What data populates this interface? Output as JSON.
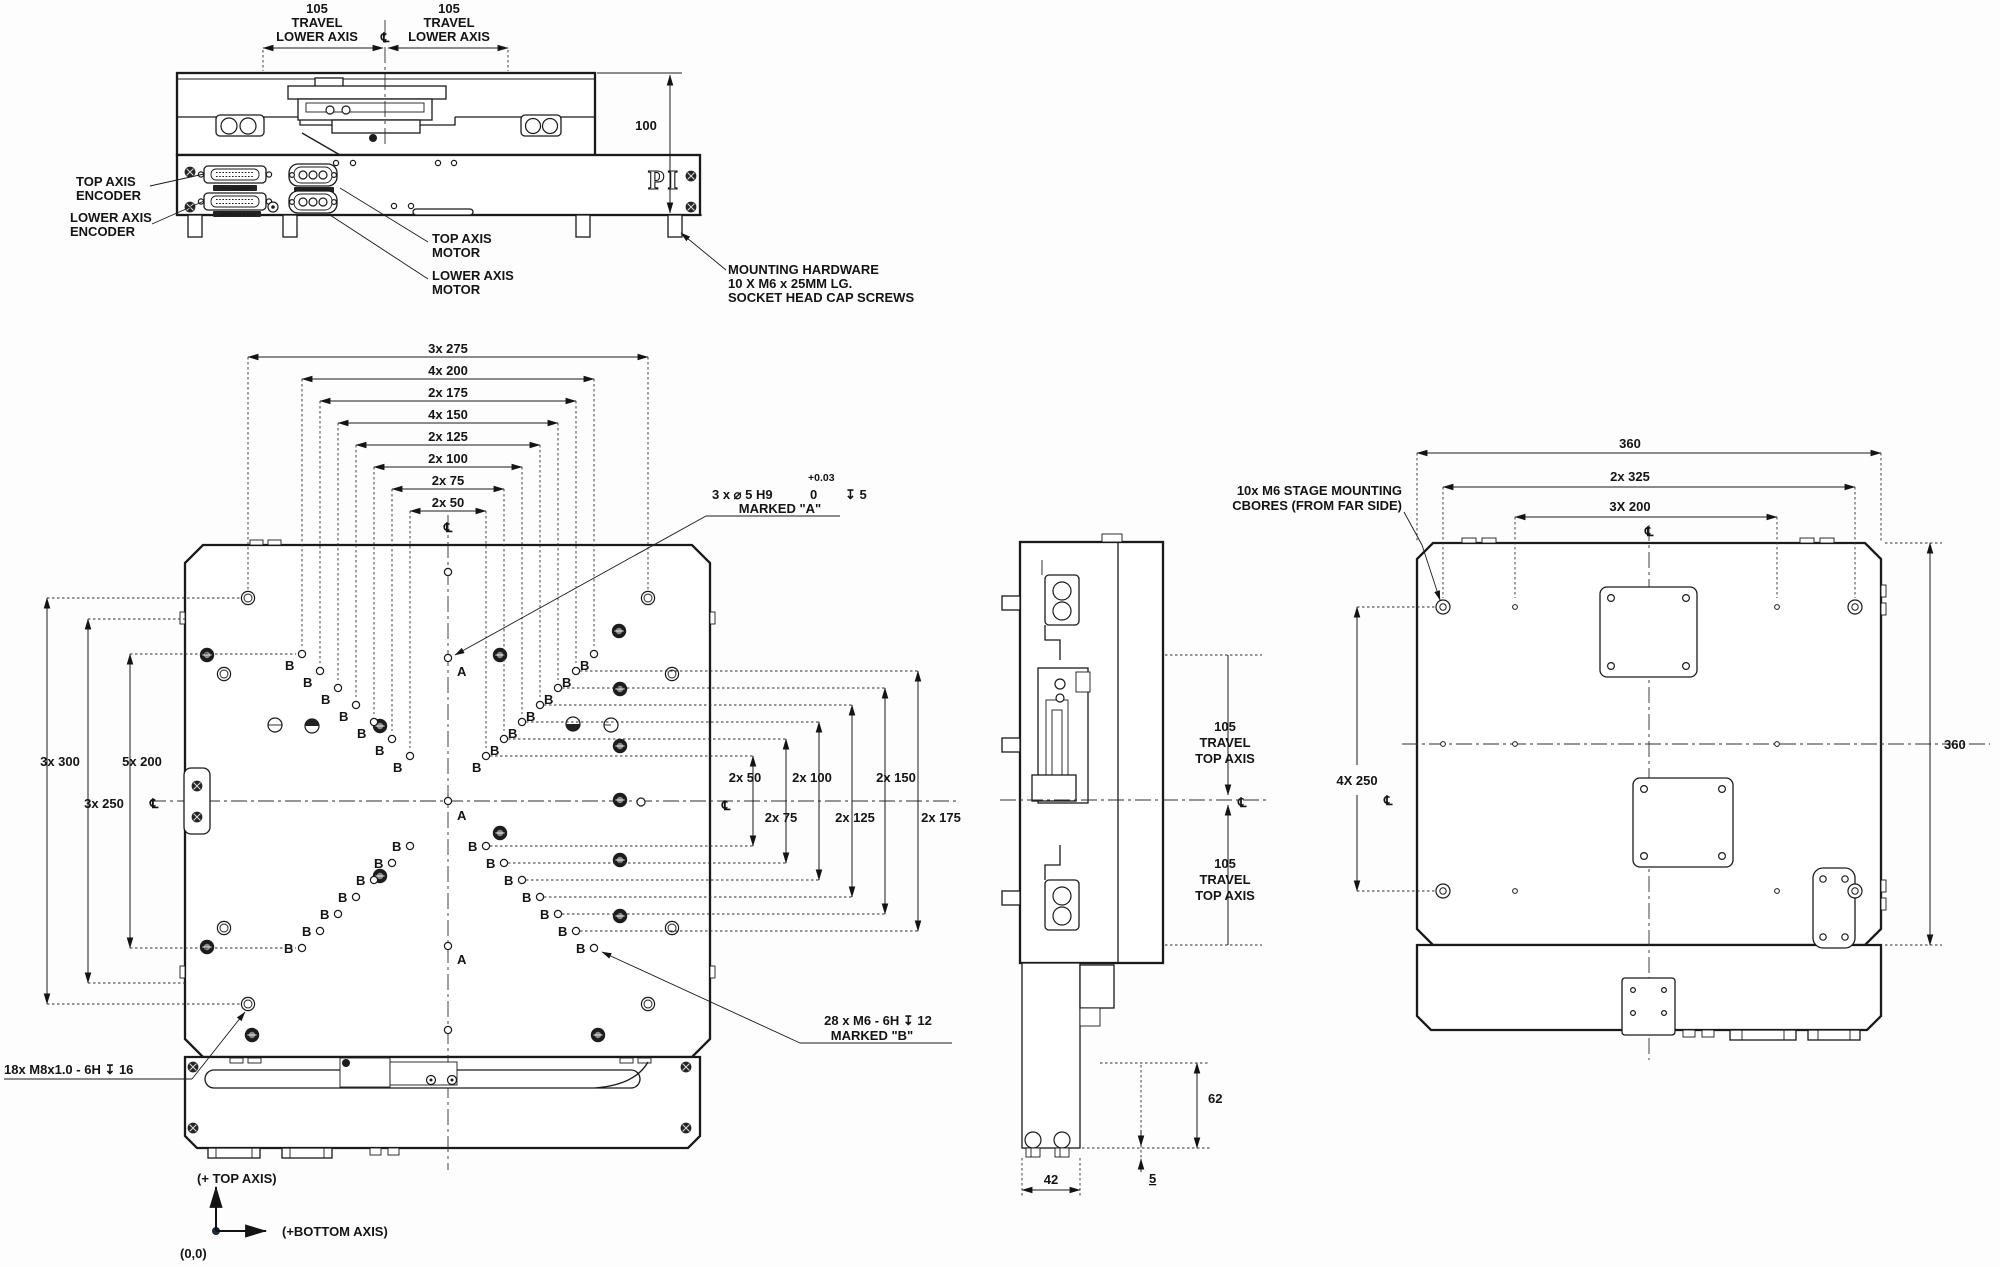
{
  "brand": "PI",
  "symbols": {
    "centerline": "℄",
    "marker_a": "A",
    "marker_b": "B"
  },
  "front": {
    "travel_left": [
      "105",
      "TRAVEL",
      "LOWER AXIS"
    ],
    "travel_right": [
      "105",
      "TRAVEL",
      "LOWER AXIS"
    ],
    "dim_height": "100",
    "encoder_top": [
      "TOP AXIS",
      "ENCODER"
    ],
    "encoder_lower": [
      "LOWER AXIS",
      "ENCODER"
    ],
    "motor_top": [
      "TOP AXIS",
      "MOTOR"
    ],
    "motor_lower": [
      "LOWER AXIS",
      "MOTOR"
    ],
    "mounting": [
      "MOUNTING HARDWARE",
      "10 X M6 x 25MM LG.",
      "SOCKET HEAD CAP SCREWS"
    ],
    "conn_labels": {
      "enc_top": "TOP AXIS ENC",
      "enc_lower": "LOWER AXIS ENC",
      "mtr_top": "TOP AXIS MTR",
      "mtr_lower": "LOWER AXIS MTR"
    }
  },
  "plan": {
    "top_dims": [
      "3x 275",
      "4x 200",
      "2x 175",
      "4x 150",
      "2x 125",
      "2x 100",
      "2x 75",
      "2x 50"
    ],
    "left_dims": [
      "3x 300",
      "5x 200",
      "3x 250"
    ],
    "right_dims": [
      "2x 50",
      "2x 100",
      "2x 150",
      "2x 75",
      "2x 125",
      "2x 175"
    ],
    "callout_a": {
      "main": "3 x ⌀ 5 H9",
      "tol_hi": "+0.03",
      "tol_lo": "0",
      "depth": "↧ 5",
      "marked": "MARKED \"A\""
    },
    "callout_b": {
      "line1": "28 x M6 - 6H ↧ 12",
      "line2": "MARKED \"B\""
    },
    "callout_m8": "18x M8x1.0 - 6H ↧ 16",
    "axes": {
      "top": "(+ TOP AXIS)",
      "bottom": "(+BOTTOM AXIS)",
      "origin": "(0,0)"
    }
  },
  "side": {
    "travel_upper": [
      "105",
      "TRAVEL",
      "TOP AXIS"
    ],
    "travel_lower": [
      "105",
      "TRAVEL",
      "TOP AXIS"
    ],
    "dim_62": "62",
    "dim_42": "42",
    "dim_5": "5"
  },
  "bottom": {
    "dim_360_top": "360",
    "dim_2x325": "2x 325",
    "dim_3x200": "3X 200",
    "dim_4x250": "4X 250",
    "dim_360_right": "360",
    "callout_cbores": [
      "10x M6  STAGE MOUNTING",
      "CBORES (FROM FAR SIDE)"
    ]
  }
}
